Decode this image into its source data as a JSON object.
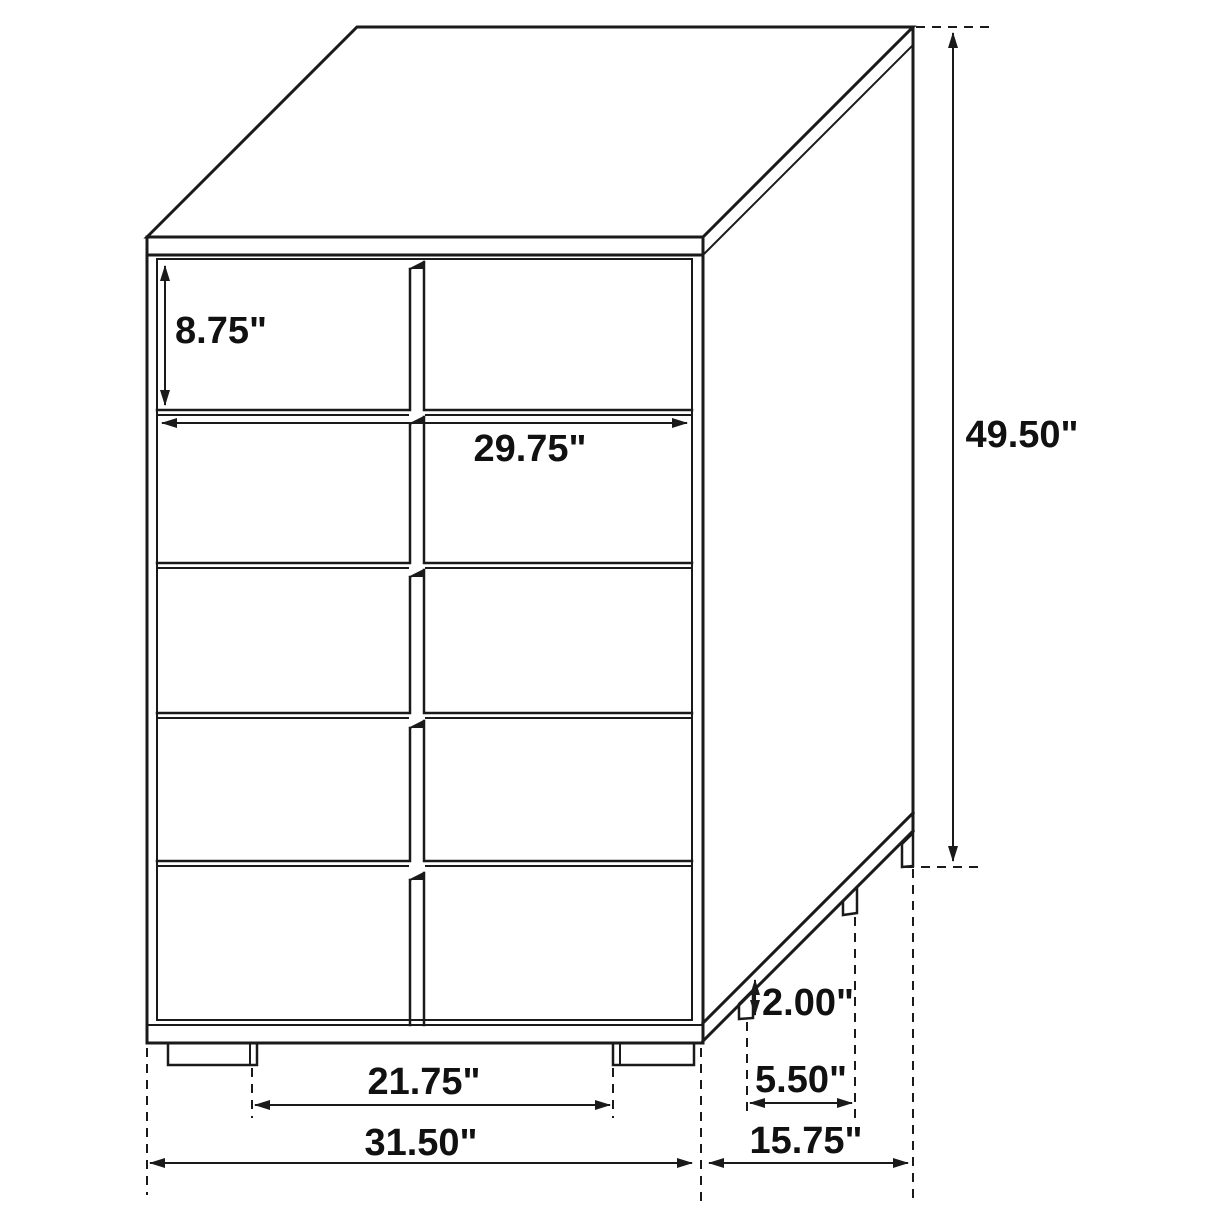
{
  "diagram_type": "furniture dimension line drawing",
  "colors": {
    "line": "#1a1a1a",
    "label": "#111111",
    "background": "#ffffff"
  },
  "dimensions": {
    "drawer_height": "8.75\"",
    "drawer_width": "29.75\"",
    "overall_height": "49.50\"",
    "base_height": "2.00\"",
    "side_leg_spacing": "5.50\"",
    "overall_depth": "15.75\"",
    "front_leg_gap": "21.75\"",
    "overall_width": "31.50\""
  }
}
